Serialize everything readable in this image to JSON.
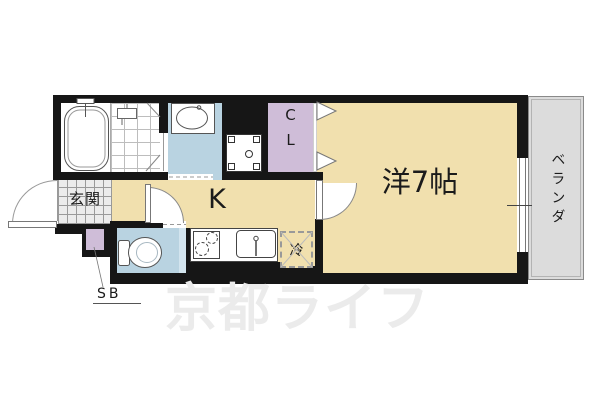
{
  "floorplan": {
    "entrance_label": "玄関",
    "kitchen_label": "K",
    "room_label": "洋7帖",
    "closet_label": "CL",
    "veranda_label": "ベランダ",
    "fridge_label": "冷",
    "shoebox_label": "SB",
    "watermark_text": "京都ライフ",
    "colors": {
      "wall": "#161616",
      "room_floor": "#f1e0ae",
      "wet_area_floor": "#b9d3e1",
      "closet_fill": "#cfbdd8",
      "balcony_fill": "#dcdcdc",
      "entry_tile": "#ececec",
      "watermark": "#ebebeb"
    },
    "fixture_icons": [
      "bathtub-icon",
      "shower-mixer-icon",
      "washbasin-icon",
      "washing-machine-pan-icon",
      "toilet-icon",
      "stove-icon",
      "kitchen-sink-icon",
      "refrigerator-space-icon",
      "folding-closet-door-icon",
      "entrance-door-swing-icon",
      "kitchen-door-swing-icon",
      "room-door-swing-icon",
      "balcony-window-icon",
      "shoe-box-icon"
    ]
  }
}
